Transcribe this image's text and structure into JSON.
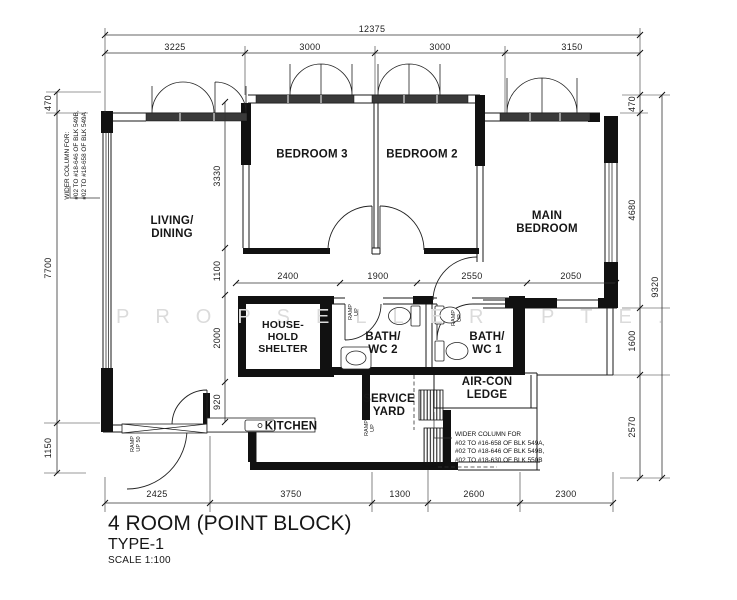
{
  "title": {
    "main": "4 ROOM (POINT BLOCK)",
    "type": "TYPE-1",
    "scale": "SCALE 1:100"
  },
  "watermark": "PROPSELLER PTE.",
  "rooms": {
    "living": "LIVING/\nDINING",
    "bedroom3": "BEDROOM 3",
    "bedroom2": "BEDROOM 2",
    "main_bedroom": "MAIN\nBEDROOM",
    "household_shelter": "HOUSE-\nHOLD\nSHELTER",
    "bath_wc2": "BATH/\nWC 2",
    "bath_wc1": "BATH/\nWC 1",
    "aircon_ledge": "AIR-CON\nLEDGE",
    "kitchen": "KITCHEN",
    "service_yard": "SERVICE\nYARD"
  },
  "dimensions": {
    "top_total": "12375",
    "top": [
      "3225",
      "3000",
      "3000",
      "3150"
    ],
    "left": [
      "470",
      "7700",
      "1150"
    ],
    "right": [
      "470",
      "4680",
      "1600",
      "2570"
    ],
    "right_total": "9320",
    "bottom": [
      "2425",
      "3750",
      "1300",
      "2600",
      "2300"
    ],
    "middle_horizontal": [
      "2400",
      "1900",
      "2550",
      "2050"
    ],
    "middle_vertical": [
      "3330",
      "1100",
      "2000",
      "920"
    ]
  },
  "annotations": {
    "left_note": "WIDER COLUMN FOR:\n#02 TO #18-646 OF BLK 549B,\n#02 TO #18-658 OF BLK 549A",
    "right_note": "WIDER COLUMN FOR\n#02 TO #16-658 OF BLK 549A,\n#02 TO #18-646 OF BLK 549B,\n#02 TO #18-630 OF BLK 550B",
    "ramp_entrance": "RAMP\nUP 50",
    "ramp_up": "RAMP\nUP"
  }
}
